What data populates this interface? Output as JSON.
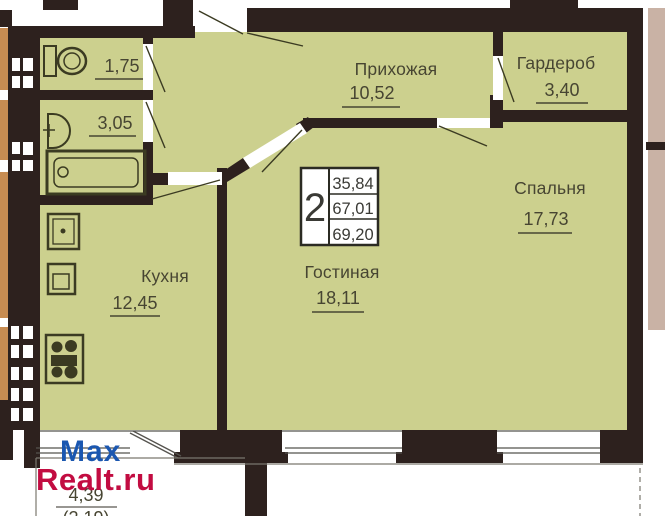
{
  "watermark": {
    "line1": "Max",
    "line2": "Realt.ru"
  },
  "stamp": {
    "rooms_count": "2",
    "values": [
      "35,84",
      "67,01",
      "69,20"
    ]
  },
  "rooms": {
    "hallway": {
      "label": "Прихожая",
      "area": "10,52"
    },
    "wardrobe": {
      "label": "Гардероб",
      "area": "3,40"
    },
    "bedroom": {
      "label": "Спальня",
      "area": "17,73"
    },
    "living": {
      "label": "Гостиная",
      "area": "18,11"
    },
    "kitchen": {
      "label": "Кухня",
      "area": "12,45"
    },
    "wc": {
      "area": "1,75"
    },
    "bathroom": {
      "area": "3,05"
    },
    "balcony": {
      "area": "4,39",
      "area_secondary": "(2,19)"
    }
  },
  "icons": [
    "toilet-icon",
    "sink-icon",
    "bathtub-icon",
    "fridge-icon",
    "washer-icon",
    "stove-icon"
  ],
  "colors": {
    "floor": "#ccd08e",
    "wall": "#2d211e",
    "neighbor_unit": "#c78c52",
    "exterior_right": "#c9b2a5",
    "watermark_blue": "#1b57b0",
    "watermark_red": "#c20c41"
  }
}
